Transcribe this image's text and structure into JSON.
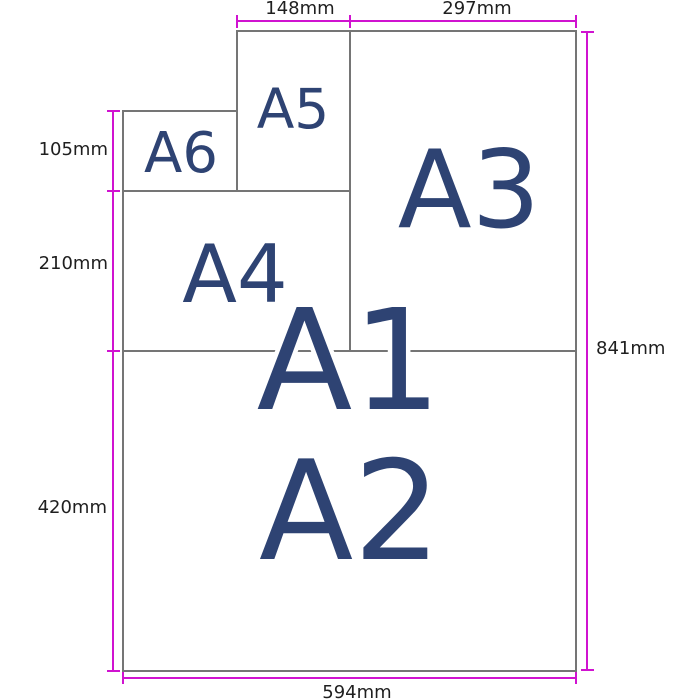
{
  "papers": {
    "a1": {
      "label": "A1"
    },
    "a2": {
      "label": "A2"
    },
    "a3": {
      "label": "A3"
    },
    "a4": {
      "label": "A4"
    },
    "a5": {
      "label": "A5"
    },
    "a6": {
      "label": "A6"
    }
  },
  "dimensions": {
    "a5_width": "148mm",
    "a3_width": "297mm",
    "a6_height": "105mm",
    "a4_height": "210mm",
    "a2_height": "420mm",
    "a1_height": "841mm",
    "a1_width": "594mm"
  },
  "colors": {
    "paper_label": "#2e4373",
    "dimension_line": "#d013d0",
    "paper_border": "#757575",
    "dimension_text": "#1f1f1f",
    "background": "#ffffff"
  }
}
